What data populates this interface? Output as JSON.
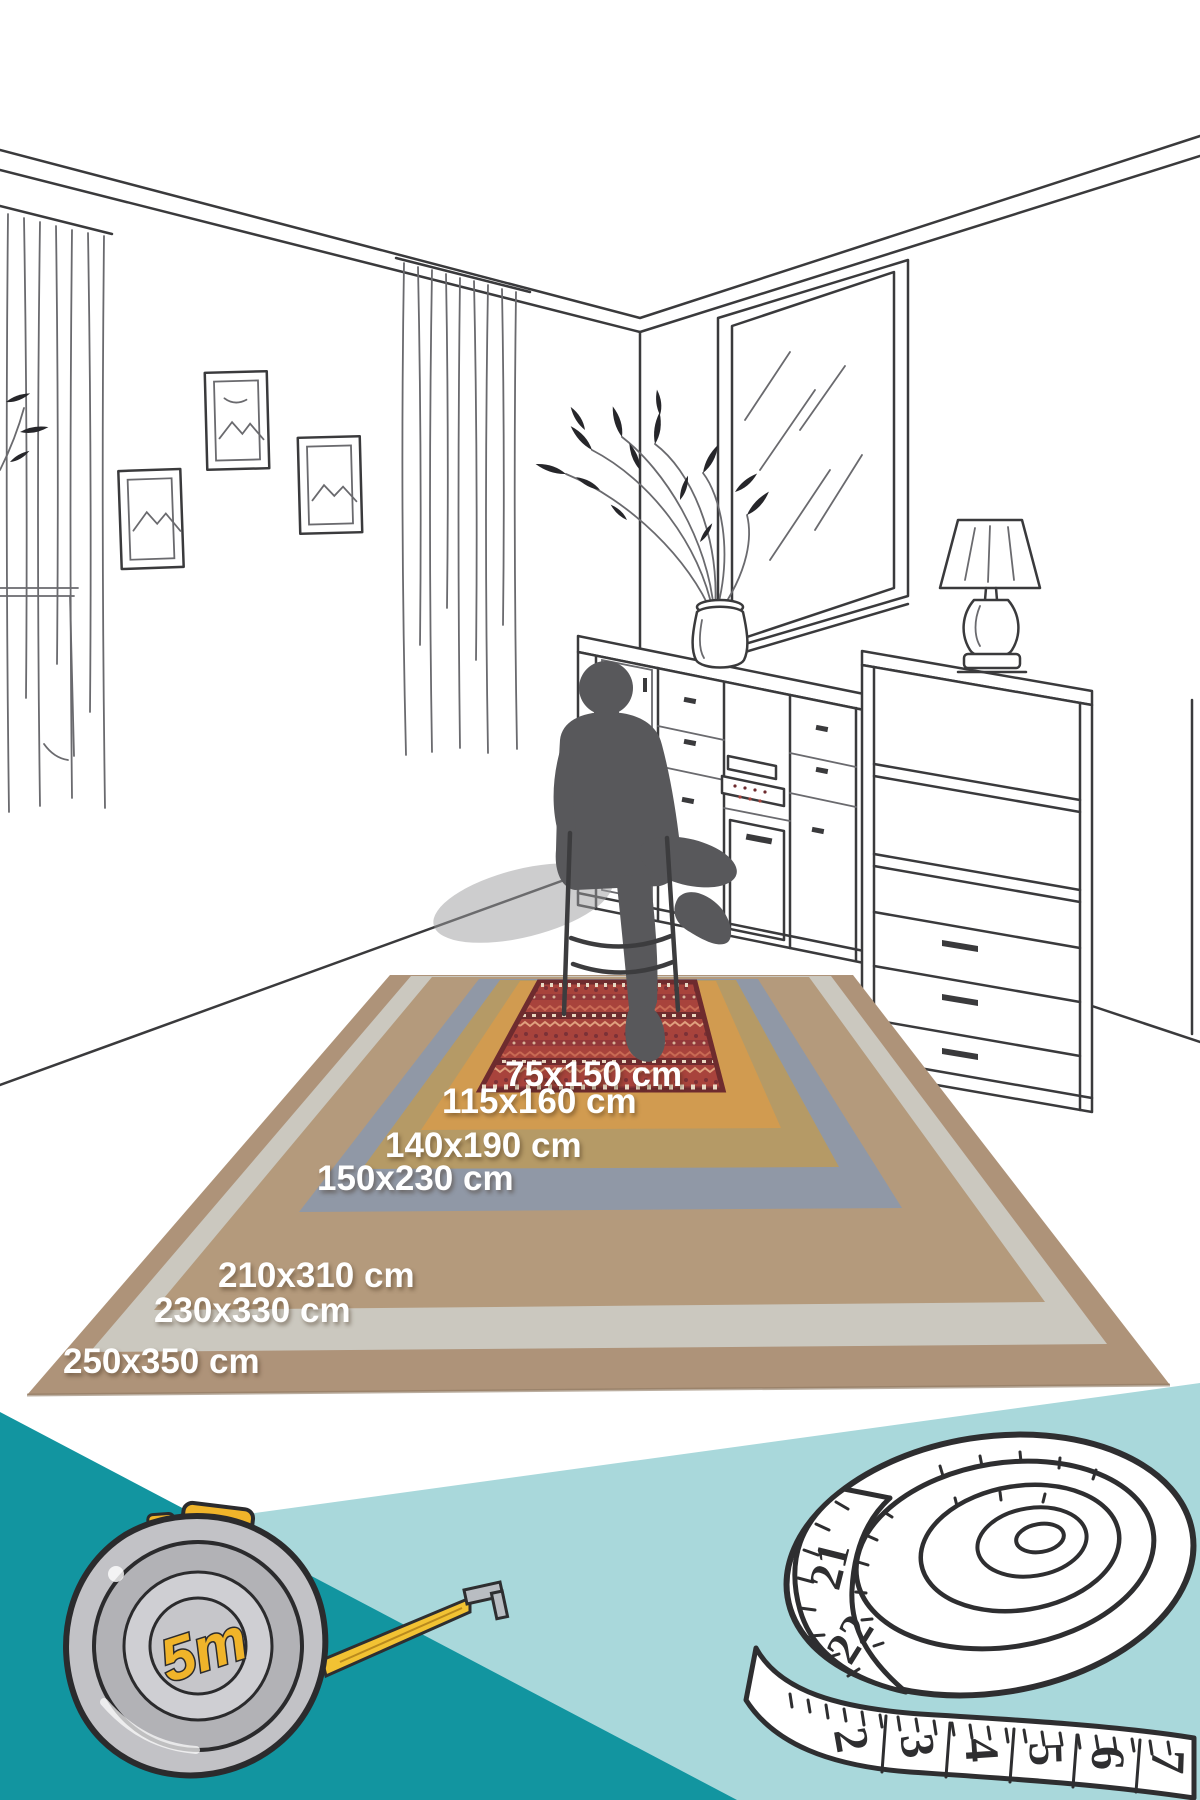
{
  "rug_sizes": [
    {
      "label": "75x150 cm",
      "color": "#a8433c"
    },
    {
      "label": "115x160 cm",
      "color": "#d19b50"
    },
    {
      "label": "140x190 cm",
      "color": "#b59a66"
    },
    {
      "label": "150x230 cm",
      "color": "#9098a6"
    },
    {
      "label": "210x310 cm",
      "color": "#b49a7c"
    },
    {
      "label": "230x330 cm",
      "color": "#cbc8bf"
    },
    {
      "label": "250x350 cm",
      "color": "#ae9379"
    }
  ],
  "tape_measure": {
    "label": "5m",
    "body_color": "#c2c2c6",
    "accent_color": "#f0b42a"
  },
  "measuring_tape": {
    "coil_numbers": [
      "21",
      "22"
    ],
    "strip_numbers": [
      "2",
      "3",
      "4",
      "5",
      "6",
      "7"
    ]
  },
  "palette": {
    "teal_dark": "#1295a0",
    "teal_light": "#a9d8db",
    "line": "#3a3a3c",
    "silhouette": "#58585b",
    "label_text": "#ffffff",
    "rug_red_dark": "#6e2b2e"
  }
}
